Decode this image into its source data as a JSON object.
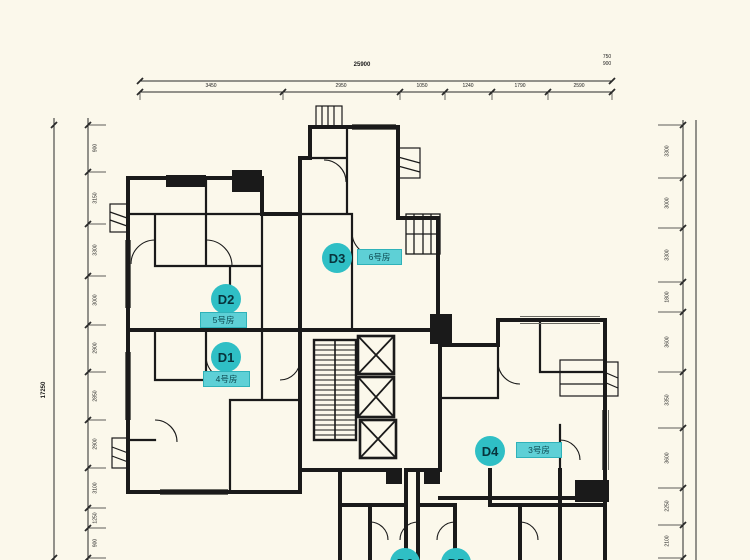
{
  "plan": {
    "type": "residential-tower-floor-plan",
    "colors": {
      "background": "#FBF8EB",
      "walls": "#1A1A1A",
      "badge_teal": "#2FBFC5",
      "pill_teal": "#5ED0D6",
      "badge_text": "#07333C"
    },
    "units": {
      "d1": {
        "id": "D1",
        "room": "4号房"
      },
      "d2": {
        "id": "D2",
        "room": "5号房"
      },
      "d3": {
        "id": "D3",
        "room": "6号房"
      },
      "d4": {
        "id": "D4",
        "room": "3号房"
      },
      "d5": {
        "id": "D5"
      },
      "d6": {
        "id": "D6"
      }
    },
    "core": {
      "stair": "stairwell",
      "elevators": 3
    }
  },
  "dimensions": {
    "top": {
      "total": "25900",
      "segments": [
        "3450",
        "2950",
        "1050",
        "1240",
        "1790",
        "2590"
      ],
      "end_stack": [
        "750",
        "900"
      ]
    },
    "left": {
      "total": "17250",
      "segments": [
        "900",
        "3150",
        "3300",
        "3000",
        "2900",
        "2850",
        "2900",
        "3100",
        "1250",
        "900"
      ]
    },
    "right": {
      "segments": [
        "3300",
        "3000",
        "3300",
        "1800",
        "3600",
        "3350",
        "3600",
        "2250",
        "2100"
      ]
    }
  }
}
